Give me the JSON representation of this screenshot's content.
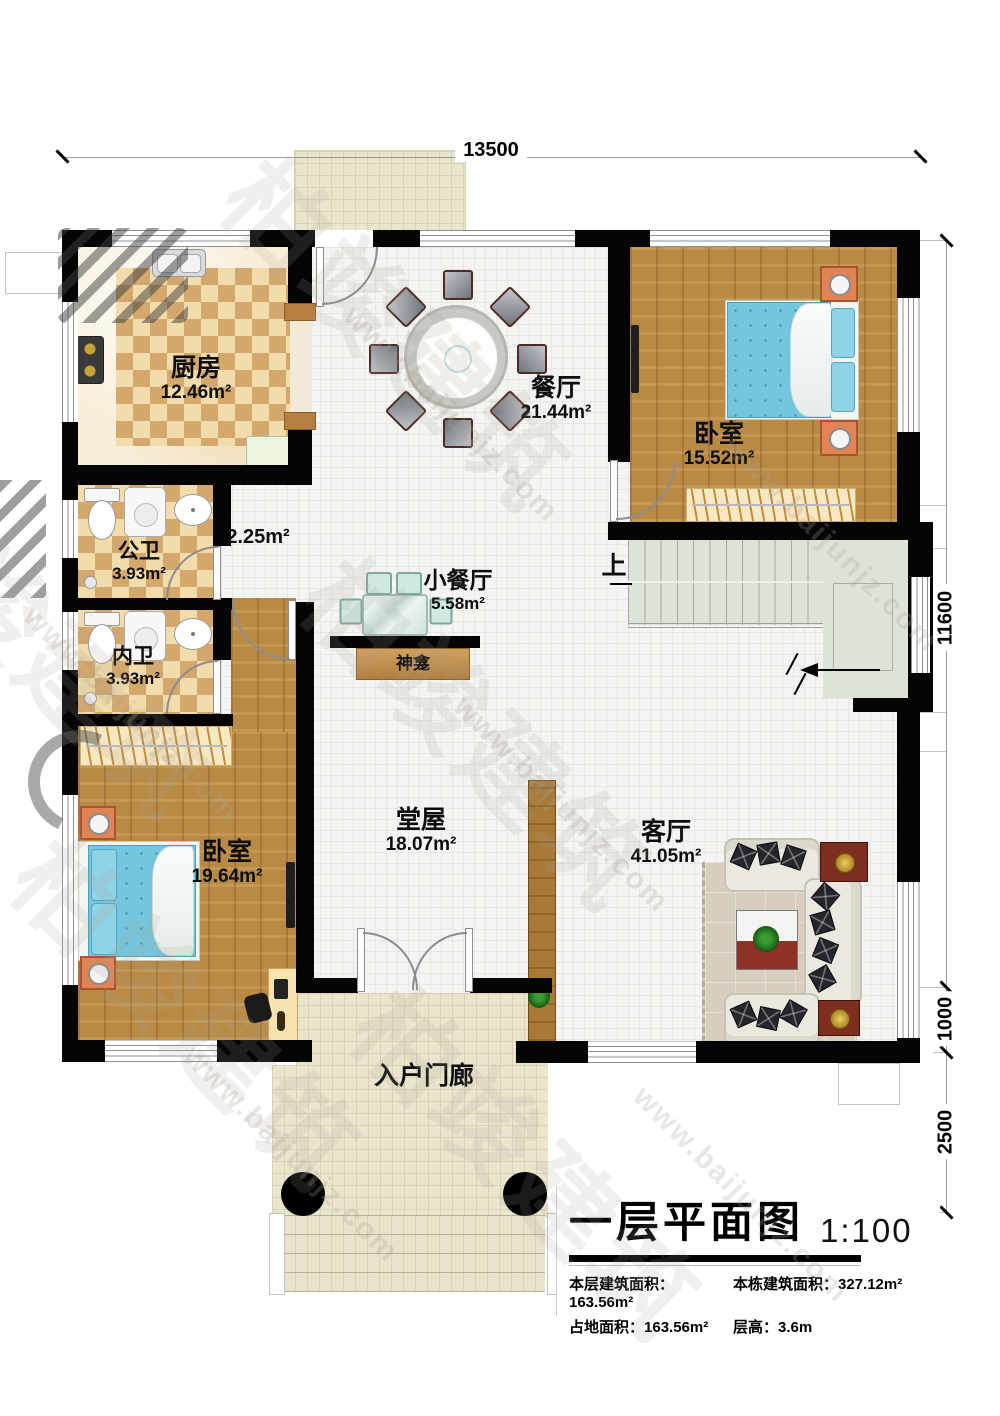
{
  "watermark": {
    "brand": "柏竣建筑",
    "url": "www.baijunjz.com"
  },
  "dimensions": {
    "top": "13500",
    "right_total": "11600",
    "right_porch": "1000",
    "right_steps": "2500"
  },
  "rooms": {
    "kitchen": {
      "name": "厨房",
      "area": "12.46m²"
    },
    "dining": {
      "name": "餐厅",
      "area": "21.44m²"
    },
    "bedroom_top": {
      "name": "卧室",
      "area": "15.52m²"
    },
    "public_bath": {
      "name": "公卫",
      "area": "3.93m²"
    },
    "corridor": {
      "area": "2.25m²"
    },
    "inner_bath": {
      "name": "内卫",
      "area": "3.93m²"
    },
    "small_dining": {
      "name": "小餐厅",
      "area": "5.58m²"
    },
    "shrine": {
      "name": "神龛"
    },
    "hall": {
      "name": "堂屋",
      "area": "18.07m²"
    },
    "living": {
      "name": "客厅",
      "area": "41.05m²"
    },
    "bedroom_bottom": {
      "name": "卧室",
      "area": "19.64m²"
    },
    "porch": {
      "name": "入户门廊"
    },
    "stairs": {
      "up_label": "上"
    }
  },
  "title_block": {
    "title": "一层平面图",
    "scale": "1:100",
    "stats": [
      {
        "label": "本层建筑面积：",
        "value": "163.56m²"
      },
      {
        "label": "本栋建筑面积：",
        "value": "327.12m²"
      },
      {
        "label": "占地面积：",
        "value": "163.56m²"
      },
      {
        "label": "层高：",
        "value": "3.6m"
      }
    ]
  }
}
